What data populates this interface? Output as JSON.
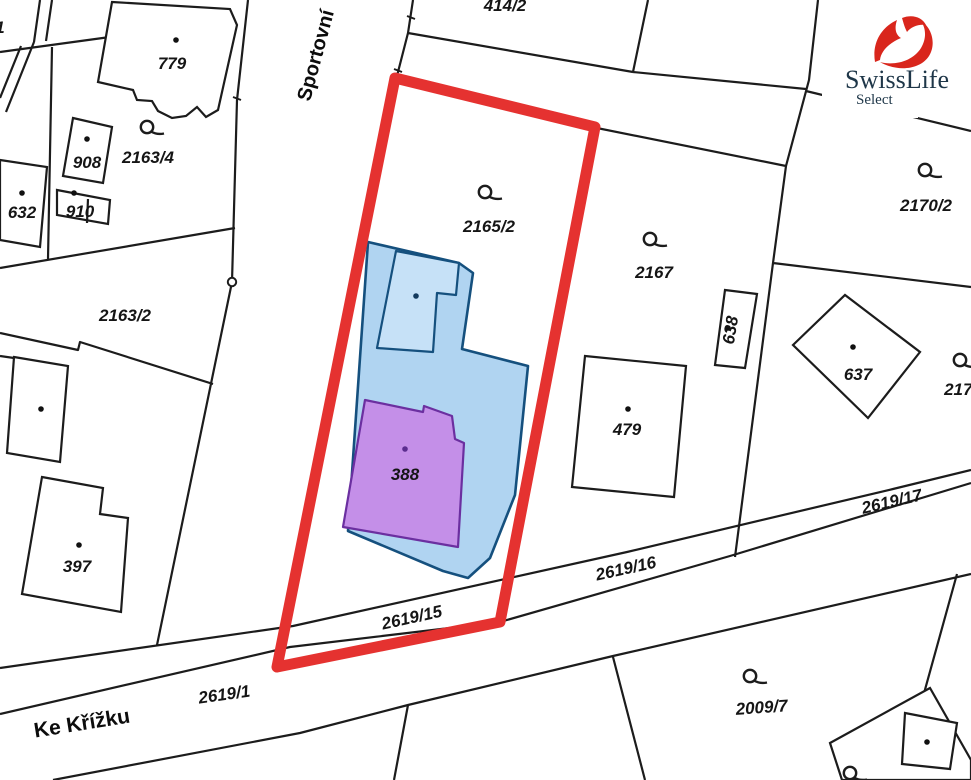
{
  "map_type": "cadastral-parcel-map",
  "colors": {
    "highlight_outline_red": "#e53230",
    "parcel_fill_blue": "#b0d4f1",
    "annex_fill_blue": "#c6e1f7",
    "blue_stroke": "#15507e",
    "house_fill_purple": "#c48fe8",
    "house_stroke_purple": "#6b2fa0",
    "house_label_purple": "#5b2d8f",
    "boundary_line": "#1c1c1c",
    "logo_red": "#d9261c",
    "logo_text": "#1e3648"
  },
  "streets": [
    {
      "name": "Sportovní"
    },
    {
      "name": "Ke Křížku"
    }
  ],
  "labels": [
    {
      "id": "parcel-414-2",
      "text": "414/2"
    },
    {
      "id": "building-779",
      "text": "779"
    },
    {
      "id": "parcel-2163-4",
      "text": "2163/4"
    },
    {
      "id": "building-908",
      "text": "908"
    },
    {
      "id": "building-910",
      "text": "910"
    },
    {
      "id": "building-632",
      "text": "632"
    },
    {
      "id": "parcel-2163-2",
      "text": "2163/2"
    },
    {
      "id": "parcel-2165-2",
      "text": "2165/2"
    },
    {
      "id": "parcel-2167",
      "text": "2167"
    },
    {
      "id": "parcel-2170-2",
      "text": "2170/2"
    },
    {
      "id": "building-638",
      "text": "638"
    },
    {
      "id": "building-637",
      "text": "637"
    },
    {
      "id": "building-479",
      "text": "479"
    },
    {
      "id": "building-397",
      "text": "397"
    },
    {
      "id": "building-388",
      "text": "388"
    },
    {
      "id": "parcel-2619-15",
      "text": "2619/15"
    },
    {
      "id": "parcel-2619-16",
      "text": "2619/16"
    },
    {
      "id": "parcel-2619-17",
      "text": "2619/17"
    },
    {
      "id": "parcel-2619-1",
      "text": "2619/1"
    },
    {
      "id": "parcel-2009-7",
      "text": "2009/7"
    },
    {
      "id": "parcel-2170-clipped",
      "text": "2170"
    },
    {
      "id": "parcel-clipped-left",
      "text": "1"
    }
  ],
  "logo": {
    "brand": "SwissLife",
    "sub": "Select"
  },
  "icons": {
    "parcel_use_symbol": "circle-with-tail-icon",
    "boundary_point": "small-circle-icon",
    "building_point": "dot-icon"
  }
}
